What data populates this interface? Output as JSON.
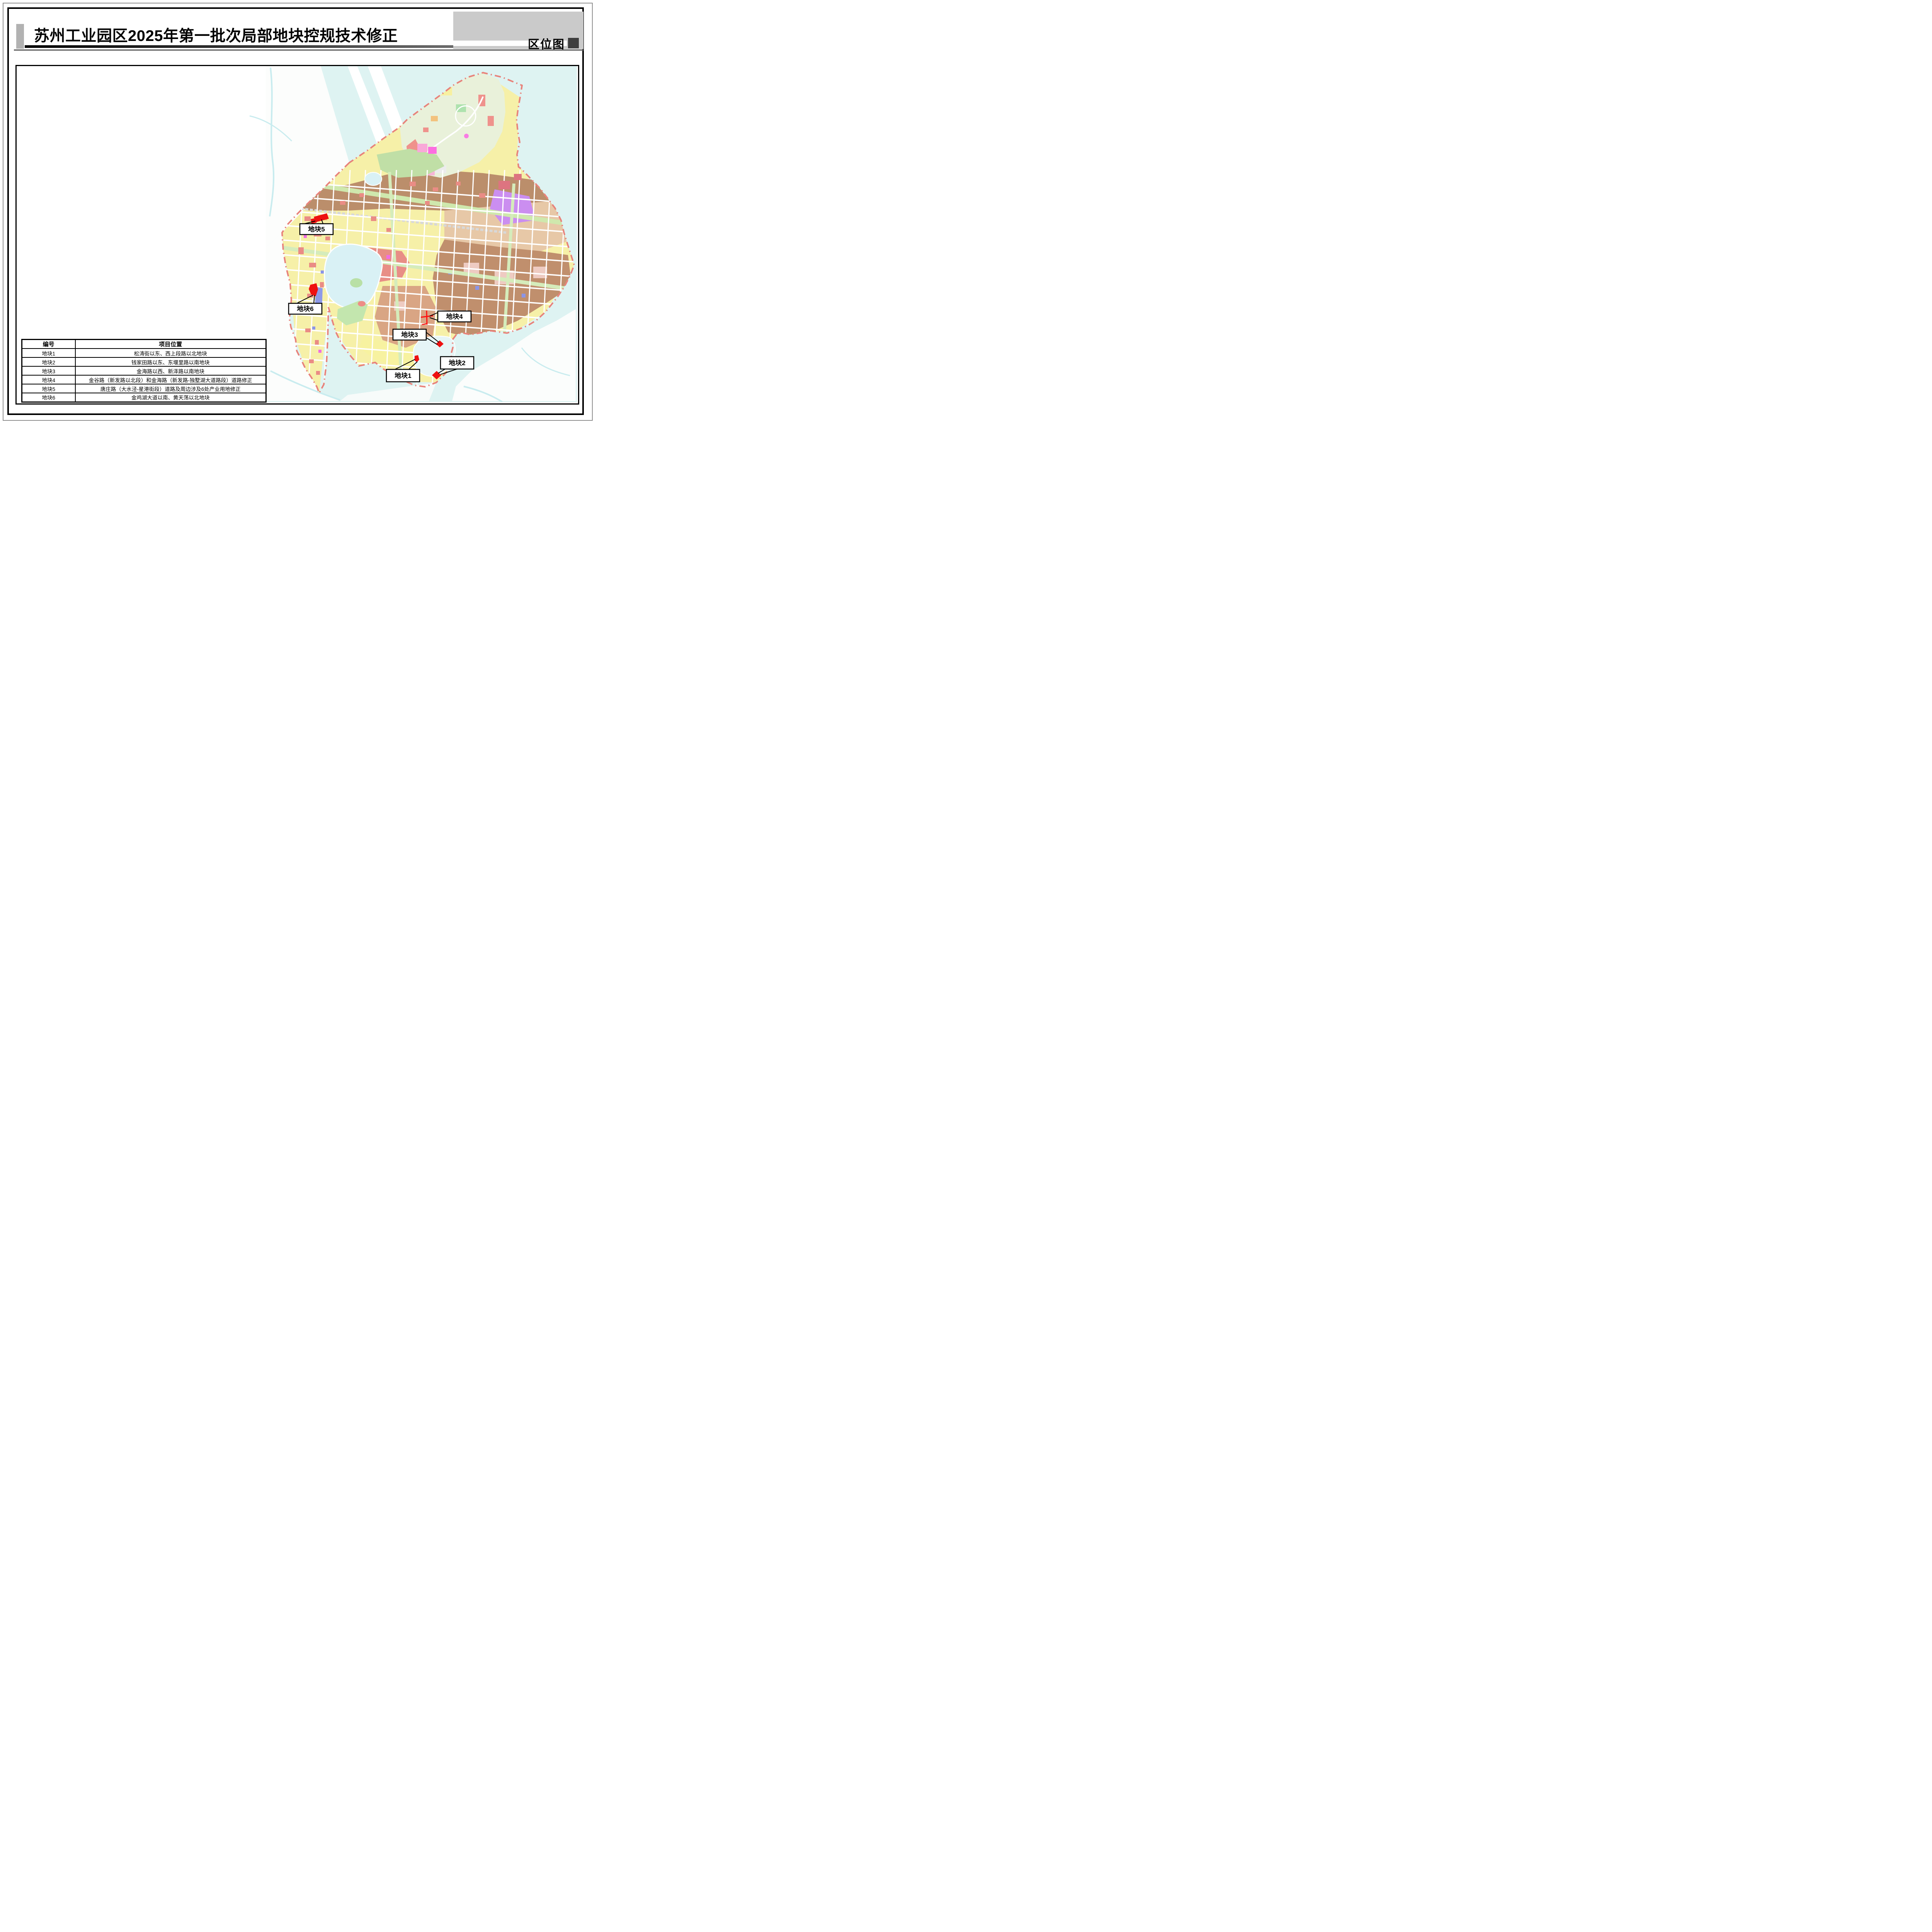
{
  "header": {
    "title": "苏州工业园区2025年第一批次局部地块控规技术修正",
    "corner_label": "区位图"
  },
  "table": {
    "headers": [
      "编号",
      "项目位置"
    ],
    "rows": [
      [
        "地块1",
        "松涛街以东、西上段路以北地块"
      ],
      [
        "地块2",
        "钱家田路以东、东堰里路以南地块"
      ],
      [
        "地块3",
        "金海路以西、新泽路以南地块"
      ],
      [
        "地块4",
        "金谷路（新发路以北段）和金海路（新发路-独墅湖大道路段）道路修正"
      ],
      [
        "地块5",
        "唐庄路（大水泾-星港街段）道路及周边涉及6处产业用地修正"
      ],
      [
        "地块6",
        "金鸡湖大道以南、黄天荡以北地块"
      ]
    ]
  },
  "map": {
    "plot_labels": [
      {
        "id": "plot1",
        "label": "地块1"
      },
      {
        "id": "plot2",
        "label": "地块2"
      },
      {
        "id": "plot3",
        "label": "地块3"
      },
      {
        "id": "plot4",
        "label": "地块4"
      },
      {
        "id": "plot5",
        "label": "地块5"
      },
      {
        "id": "plot6",
        "label": "地块6"
      }
    ],
    "colors": {
      "water": "#def3f2",
      "boundary_dashed": "#e8837b",
      "plot_marker_red": "#ee1111",
      "residential_yellow": "#f7f2a2",
      "industrial_brown": "#bb8e6b",
      "commercial_red": "#ea8c85",
      "special_purple": "#cb8ef0",
      "greenway": "#cde9ab"
    }
  }
}
